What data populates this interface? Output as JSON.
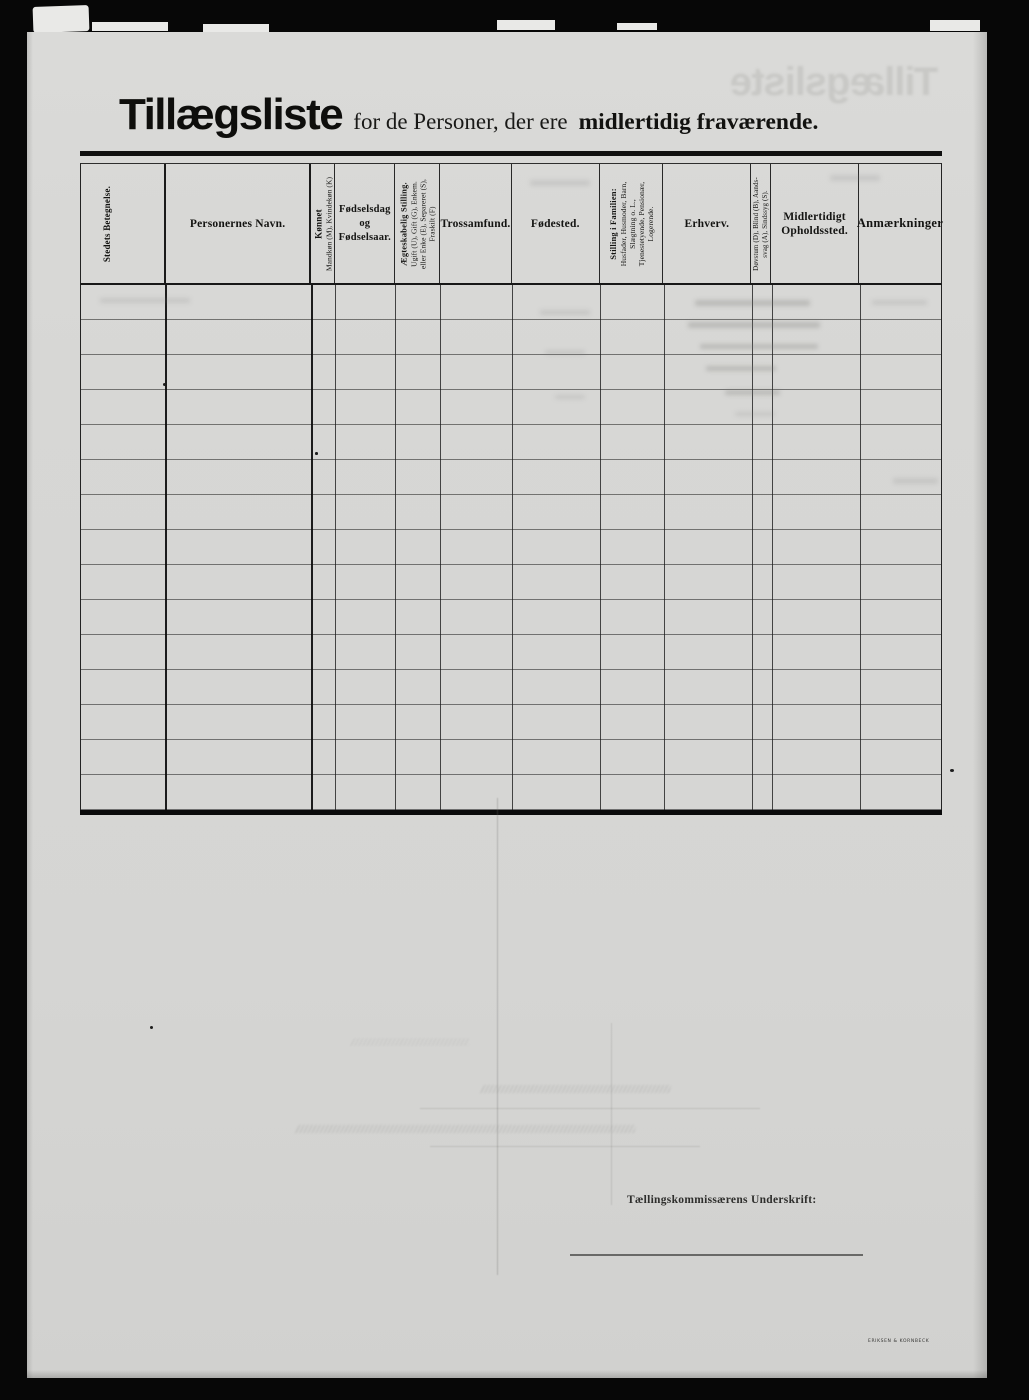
{
  "header": {
    "title": "Tillægsliste",
    "subtitle_regular": "for de Personer, der ere",
    "subtitle_bold": "midlertidig fraværende."
  },
  "table": {
    "row_count": 15,
    "rows_empty": true,
    "columns": [
      {
        "name": "stedets-betegnelse",
        "orientation": "vertical",
        "lines": [
          {
            "text": "Stedets Betegnelse.",
            "style": "heading"
          }
        ]
      },
      {
        "name": "personernes-navn",
        "orientation": "horizontal",
        "lines": [
          {
            "text": "Personernes Navn.",
            "style": "heading"
          }
        ]
      },
      {
        "name": "koennet",
        "orientation": "vertical",
        "lines": [
          {
            "text": "Kønnet",
            "style": "heading"
          },
          {
            "text": "Mandkøn (M), Kvindekøn (K)",
            "style": "sub"
          }
        ]
      },
      {
        "name": "foedselsdag-og-foedselsaar",
        "orientation": "horizontal",
        "lines": [
          {
            "text": "Fødselsdag",
            "style": "heading"
          },
          {
            "text": "og",
            "style": "heading"
          },
          {
            "text": "Fødselsaar.",
            "style": "heading"
          }
        ]
      },
      {
        "name": "aegteskabelig-stilling",
        "orientation": "vertical",
        "lines": [
          {
            "text": "Ægteskabelig Stilling.",
            "style": "heading"
          },
          {
            "text": "Ugift (U), Gift (G), Enkem.",
            "style": "sub"
          },
          {
            "text": "eller Enke (E), Separeret (S),",
            "style": "sub"
          },
          {
            "text": "Fraskilt (F)",
            "style": "sub"
          }
        ]
      },
      {
        "name": "trossamfund",
        "orientation": "horizontal",
        "lines": [
          {
            "text": "Trossamfund.",
            "style": "heading"
          }
        ]
      },
      {
        "name": "foedested",
        "orientation": "horizontal",
        "lines": [
          {
            "text": "Fødested.",
            "style": "heading"
          }
        ]
      },
      {
        "name": "stilling-i-familien",
        "orientation": "vertical",
        "lines": [
          {
            "text": "Stilling i Familien:",
            "style": "heading"
          },
          {
            "text": "Husfader, Husmoder, Barn,",
            "style": "sub"
          },
          {
            "text": "Slægtning o. L.,",
            "style": "sub"
          },
          {
            "text": "Tjenestetyende, Pensionær,",
            "style": "sub"
          },
          {
            "text": "Logerende.",
            "style": "sub"
          }
        ]
      },
      {
        "name": "erhverv",
        "orientation": "horizontal",
        "lines": [
          {
            "text": "Erhverv.",
            "style": "heading"
          }
        ]
      },
      {
        "name": "doevstum-blind-aandssvag-sindssyg",
        "orientation": "vertical",
        "lines": [
          {
            "text": "Døvstum (D), Blind (B), Aands-",
            "style": "sub"
          },
          {
            "text": "svag (A), Sindssyg (S).",
            "style": "sub"
          }
        ]
      },
      {
        "name": "midlertidigt-opholdssted",
        "orientation": "horizontal",
        "lines": [
          {
            "text": "Midlertidigt",
            "style": "heading"
          },
          {
            "text": "Opholdssted.",
            "style": "heading"
          }
        ]
      },
      {
        "name": "anmaerkninger",
        "orientation": "horizontal",
        "lines": [
          {
            "text": "Anmærkninger",
            "style": "heading"
          }
        ]
      }
    ]
  },
  "footer": {
    "signature_label": "Tællingskommissærens Underskrift:",
    "printer_imprint": "ERIKSEN & KORNBECK"
  },
  "artifacts": {
    "bleed_title_mirrored": "Tillægsliste"
  }
}
